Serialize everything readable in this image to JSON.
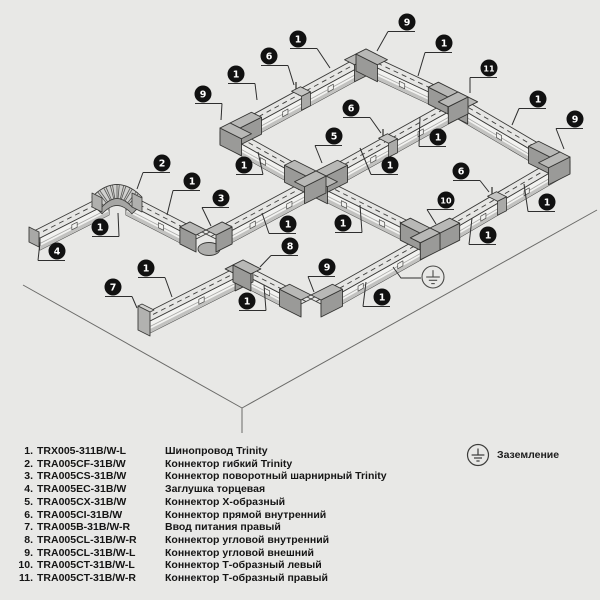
{
  "palette": {
    "bg": "#e8e8e6",
    "outline": "#3a3a38",
    "plane_line": "#6a6a68",
    "track_top": "#e6e6e4",
    "track_side": "#f2f2f0",
    "track_stripe": "#c2c2c0",
    "track_lip": "#a8a8a6",
    "conn_top": "#b8b8b6",
    "conn_side": "#9a9a98",
    "c6_top": "#c4c4c2",
    "c6_side": "#aaaaa8",
    "flex_band": "#d0d0ce",
    "flex_shadow": "#a6a6a4",
    "callout_fill": "#111111",
    "callout_text": "#ffffff",
    "leader": "#2e2e2e"
  },
  "diagram": {
    "plane_lines": [
      [
        23,
        285,
        242,
        408
      ],
      [
        242,
        408,
        597,
        210
      ],
      [
        242,
        408,
        242,
        433
      ]
    ],
    "runs": [
      {
        "axis": "u",
        "p": [
          30,
          233,
          99,
          198
        ]
      },
      {
        "axis": "v",
        "p": [
          136,
          198,
          206,
          234
        ]
      },
      {
        "axis": "u",
        "p": [
          206,
          234,
          316,
          175
        ]
      },
      {
        "axis": "v",
        "p": [
          230,
          127,
          316,
          175
        ]
      },
      {
        "axis": "u",
        "p": [
          230,
          127,
          366,
          53
        ]
      },
      {
        "axis": "v",
        "p": [
          366,
          53,
          458,
          96
        ]
      },
      {
        "axis": "u",
        "p": [
          316,
          175,
          458,
          96
        ]
      },
      {
        "axis": "v",
        "p": [
          458,
          96,
          560,
          156
        ]
      },
      {
        "axis": "u",
        "p": [
          430,
          232,
          560,
          156
        ]
      },
      {
        "axis": "v",
        "p": [
          316,
          175,
          430,
          232
        ]
      },
      {
        "axis": "u",
        "p": [
          140,
          316,
          243,
          264
        ]
      },
      {
        "axis": "v",
        "p": [
          243,
          264,
          311,
          299
        ]
      },
      {
        "axis": "u",
        "p": [
          311,
          299,
          430,
          232
        ]
      }
    ],
    "connectors": [
      {
        "type": "elbow",
        "name": "corner-connector-outer-top",
        "x": 366,
        "y": 53,
        "stubs": [
          "sw",
          "se"
        ],
        "len": 24
      },
      {
        "type": "tee",
        "name": "t-connector-right",
        "x": 458,
        "y": 96,
        "stubs": [
          "nw",
          "se",
          "sw"
        ],
        "len": 22
      },
      {
        "type": "elbow",
        "name": "corner-connector-outer-left",
        "x": 230,
        "y": 127,
        "stubs": [
          "ne",
          "se"
        ],
        "len": 24
      },
      {
        "type": "elbow",
        "name": "corner-connector-outer-right",
        "x": 560,
        "y": 156,
        "stubs": [
          "nw",
          "sw"
        ],
        "len": 24
      },
      {
        "type": "cross",
        "name": "x-connector",
        "x": 316,
        "y": 175,
        "stubs": [
          "ne",
          "se",
          "sw",
          "nw"
        ],
        "len": 24
      },
      {
        "type": "tee",
        "name": "t-connector-left",
        "x": 430,
        "y": 232,
        "stubs": [
          "ne",
          "sw",
          "nw"
        ],
        "len": 22
      },
      {
        "type": "swivel",
        "name": "swivel-hinge-connector",
        "x": 206,
        "y": 234,
        "stubs": [
          "nw",
          "ne"
        ],
        "len": 18
      },
      {
        "type": "elbow",
        "name": "corner-connector-inner",
        "x": 243,
        "y": 264,
        "stubs": [
          "sw",
          "se"
        ],
        "len": 20
      },
      {
        "type": "elbow",
        "name": "corner-connector-outer-bottom",
        "x": 311,
        "y": 299,
        "stubs": [
          "nw",
          "ne"
        ],
        "len": 24
      }
    ],
    "straight_connectors": [
      [
        296,
        91
      ],
      [
        383,
        138
      ],
      [
        492,
        196
      ]
    ],
    "end_cap": {
      "x": 30,
      "y": 233
    },
    "power_feed": {
      "x": 140,
      "y": 316
    },
    "flex_bend": {
      "a": [
        97,
        202
      ],
      "c": [
        117,
        181
      ],
      "b": [
        137,
        202
      ]
    },
    "ground_symbol": {
      "cx": 433,
      "cy": 277,
      "r": 11,
      "leader": [
        [
          421,
          278
        ],
        [
          401,
          278
        ],
        [
          393,
          267
        ]
      ]
    },
    "callouts": [
      {
        "n": "4",
        "x": 57,
        "y": 251,
        "tx": 40,
        "ty": 242
      },
      {
        "n": "1",
        "x": 100,
        "y": 227,
        "tx": 118,
        "ty": 213
      },
      {
        "n": "2",
        "x": 162,
        "y": 163,
        "tx": 137,
        "ty": 189
      },
      {
        "n": "1",
        "x": 192,
        "y": 181,
        "tx": 167,
        "ty": 215
      },
      {
        "n": "3",
        "x": 221,
        "y": 198,
        "tx": 211,
        "ty": 226
      },
      {
        "n": "1",
        "x": 288,
        "y": 224,
        "tx": 262,
        "ty": 213
      },
      {
        "n": "1",
        "x": 244,
        "y": 165,
        "tx": 258,
        "ty": 152
      },
      {
        "n": "9",
        "x": 203,
        "y": 94,
        "tx": 221,
        "ty": 120
      },
      {
        "n": "6",
        "x": 269,
        "y": 56,
        "tx": 294,
        "ty": 85
      },
      {
        "n": "1",
        "x": 236,
        "y": 74,
        "tx": 257,
        "ty": 100
      },
      {
        "n": "1",
        "x": 298,
        "y": 39,
        "tx": 330,
        "ty": 68
      },
      {
        "n": "9",
        "x": 407,
        "y": 22,
        "tx": 377,
        "ty": 51
      },
      {
        "n": "1",
        "x": 444,
        "y": 43,
        "tx": 418,
        "ty": 76
      },
      {
        "n": "11",
        "x": 489,
        "y": 68,
        "tx": 470,
        "ty": 93
      },
      {
        "n": "6",
        "x": 351,
        "y": 108,
        "tx": 381,
        "ty": 133
      },
      {
        "n": "1",
        "x": 438,
        "y": 137,
        "tx": 420,
        "ty": 117
      },
      {
        "n": "1",
        "x": 390,
        "y": 165,
        "tx": 360,
        "ty": 148
      },
      {
        "n": "5",
        "x": 334,
        "y": 136,
        "tx": 322,
        "ty": 163
      },
      {
        "n": "1",
        "x": 538,
        "y": 99,
        "tx": 512,
        "ty": 125
      },
      {
        "n": "9",
        "x": 575,
        "y": 119,
        "tx": 564,
        "ty": 149
      },
      {
        "n": "1",
        "x": 547,
        "y": 202,
        "tx": 524,
        "ty": 184
      },
      {
        "n": "6",
        "x": 461,
        "y": 171,
        "tx": 489,
        "ty": 192
      },
      {
        "n": "1",
        "x": 488,
        "y": 235,
        "tx": 472,
        "ty": 218
      },
      {
        "n": "1",
        "x": 343,
        "y": 223,
        "tx": 360,
        "ty": 205
      },
      {
        "n": "10",
        "x": 446,
        "y": 200,
        "tx": 436,
        "ty": 224
      },
      {
        "n": "1",
        "x": 382,
        "y": 297,
        "tx": 366,
        "ty": 282
      },
      {
        "n": "9",
        "x": 327,
        "y": 267,
        "tx": 314,
        "ty": 292
      },
      {
        "n": "1",
        "x": 247,
        "y": 301,
        "tx": 264,
        "ty": 285
      },
      {
        "n": "8",
        "x": 290,
        "y": 246,
        "tx": 260,
        "ty": 267
      },
      {
        "n": "1",
        "x": 146,
        "y": 268,
        "tx": 172,
        "ty": 297
      },
      {
        "n": "7",
        "x": 113,
        "y": 287,
        "tx": 137,
        "ty": 308
      }
    ]
  },
  "legend": {
    "items": [
      {
        "num": "1.",
        "code": "TRX005-311B/W-L",
        "desc": "Шинопровод Trinity"
      },
      {
        "num": "2.",
        "code": "TRA005CF-31B/W",
        "desc": "Коннектор гибкий Trinity"
      },
      {
        "num": "3.",
        "code": "TRA005CS-31B/W",
        "desc": "Коннектор поворотный шарнирный Trinity"
      },
      {
        "num": "4.",
        "code": "TRA005EC-31B/W",
        "desc": "Заглушка торцевая"
      },
      {
        "num": "5.",
        "code": "TRA005CX-31B/W",
        "desc": "Коннектор Х-образный"
      },
      {
        "num": "6.",
        "code": "TRA005CI-31B/W",
        "desc": "Коннектор прямой внутренний"
      },
      {
        "num": "7.",
        "code": "TRA005B-31B/W-R",
        "desc": "Ввод питания правый"
      },
      {
        "num": "8.",
        "code": "TRA005CL-31B/W-R",
        "desc": "Коннектор угловой внутренний"
      },
      {
        "num": "9.",
        "code": "TRA005CL-31B/W-L",
        "desc": "Коннектор угловой внешний"
      },
      {
        "num": "10.",
        "code": "TRA005CT-31B/W-L",
        "desc": "Коннектор Т-образный левый"
      },
      {
        "num": "11.",
        "code": "TRA005CT-31B/W-R",
        "desc": "Коннектор Т-образный правый"
      }
    ]
  },
  "ground_legend": {
    "label": "Заземление"
  }
}
